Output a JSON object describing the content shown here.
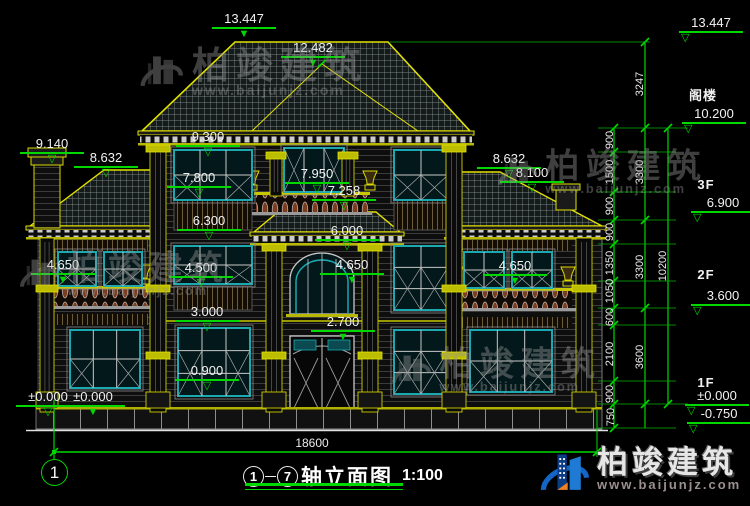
{
  "accent": {
    "dim_green": "#00d800",
    "cad_yellow": "#e2e200",
    "window_teal": "#1ba8b0",
    "logo_blue": "#1565c8",
    "logo_orange": "#f08020"
  },
  "title": {
    "axis_start": "1",
    "axis_end": "7",
    "name": "轴立面图",
    "scale": "1:100"
  },
  "axis_bubble": {
    "label": "1"
  },
  "overall_dim": {
    "label": "18600"
  },
  "markers": [
    {
      "label": "13.447",
      "x": 244,
      "y": 12,
      "filled": true
    },
    {
      "label": "12.482",
      "x": 313,
      "y": 41,
      "filled": true
    },
    {
      "label": "9.140",
      "x": 52,
      "y": 137,
      "filled": false
    },
    {
      "label": "8.632",
      "x": 106,
      "y": 151,
      "filled": false
    },
    {
      "label": "9.300",
      "x": 208,
      "y": 130,
      "filled": false
    },
    {
      "label": "7.800",
      "x": 199,
      "y": 171,
      "filled": false
    },
    {
      "label": "7.950",
      "x": 317,
      "y": 167,
      "filled": false
    },
    {
      "label": "7.258",
      "x": 344,
      "y": 184,
      "filled": false
    },
    {
      "label": "6.300",
      "x": 209,
      "y": 214,
      "filled": false
    },
    {
      "label": "6.000",
      "x": 347,
      "y": 224,
      "filled": false
    },
    {
      "label": "8.632",
      "x": 509,
      "y": 152,
      "filled": false
    },
    {
      "label": "8.100",
      "x": 532,
      "y": 166,
      "filled": false
    },
    {
      "label": "4.650",
      "x": 63,
      "y": 258,
      "filled": true
    },
    {
      "label": "4.500",
      "x": 201,
      "y": 261,
      "filled": false
    },
    {
      "label": "4.650",
      "x": 352,
      "y": 258,
      "filled": true
    },
    {
      "label": "4.650",
      "x": 515,
      "y": 259,
      "filled": true
    },
    {
      "label": "3.000",
      "x": 207,
      "y": 305,
      "filled": false
    },
    {
      "label": "2.700",
      "x": 343,
      "y": 315,
      "filled": true
    },
    {
      "label": "0.900",
      "x": 207,
      "y": 364,
      "filled": false
    },
    {
      "label": "±0.000",
      "x": 48,
      "y": 390,
      "filled": false
    },
    {
      "label": "±0.000",
      "x": 93,
      "y": 390,
      "filled": true
    },
    {
      "label": "13.447",
      "x": 711,
      "y": 16,
      "filled": false,
      "tleft": true
    },
    {
      "label": "10.200",
      "x": 714,
      "y": 107,
      "filled": false,
      "tleft": true
    },
    {
      "label": "6.900",
      "x": 723,
      "y": 196,
      "filled": false,
      "tleft": true
    },
    {
      "label": "3.600",
      "x": 723,
      "y": 289,
      "filled": false,
      "tleft": true
    },
    {
      "label": "±0.000",
      "x": 717,
      "y": 389,
      "filled": false,
      "tleft": true
    },
    {
      "label": "-0.750",
      "x": 719,
      "y": 407,
      "filled": false,
      "tleft": true
    }
  ],
  "floor_labels": [
    {
      "label": "阁楼",
      "x": 703,
      "y": 85
    },
    {
      "label": "3F",
      "x": 706,
      "y": 177
    },
    {
      "label": "2F",
      "x": 706,
      "y": 267
    },
    {
      "label": "1F",
      "x": 706,
      "y": 375
    }
  ],
  "chain_dims": [
    {
      "label": "900",
      "x": 610,
      "y": 140
    },
    {
      "label": "1500",
      "x": 610,
      "y": 172
    },
    {
      "label": "900",
      "x": 610,
      "y": 206
    },
    {
      "label": "900",
      "x": 610,
      "y": 232
    },
    {
      "label": "1350",
      "x": 610,
      "y": 263
    },
    {
      "label": "1050",
      "x": 610,
      "y": 291
    },
    {
      "label": "600",
      "x": 610,
      "y": 317
    },
    {
      "label": "2100",
      "x": 610,
      "y": 354
    },
    {
      "label": "900",
      "x": 610,
      "y": 394
    },
    {
      "label": "750",
      "x": 611,
      "y": 417
    },
    {
      "label": "3247",
      "x": 640,
      "y": 84
    },
    {
      "label": "3300",
      "x": 640,
      "y": 172
    },
    {
      "label": "3300",
      "x": 640,
      "y": 267
    },
    {
      "label": "3600",
      "x": 640,
      "y": 357
    },
    {
      "label": "10200",
      "x": 663,
      "y": 266
    }
  ],
  "watermark": {
    "brand": "柏竣建筑",
    "url": "www.baijunjz.com",
    "positions": [
      {
        "x": 134,
        "y": 46,
        "s": 1.0
      },
      {
        "x": 492,
        "y": 148,
        "s": 0.92
      },
      {
        "x": 14,
        "y": 250,
        "s": 0.92
      },
      {
        "x": 386,
        "y": 346,
        "s": 0.92
      }
    ]
  },
  "logo": {
    "brand": "柏竣建筑",
    "url": "www.baijunjz.com"
  }
}
